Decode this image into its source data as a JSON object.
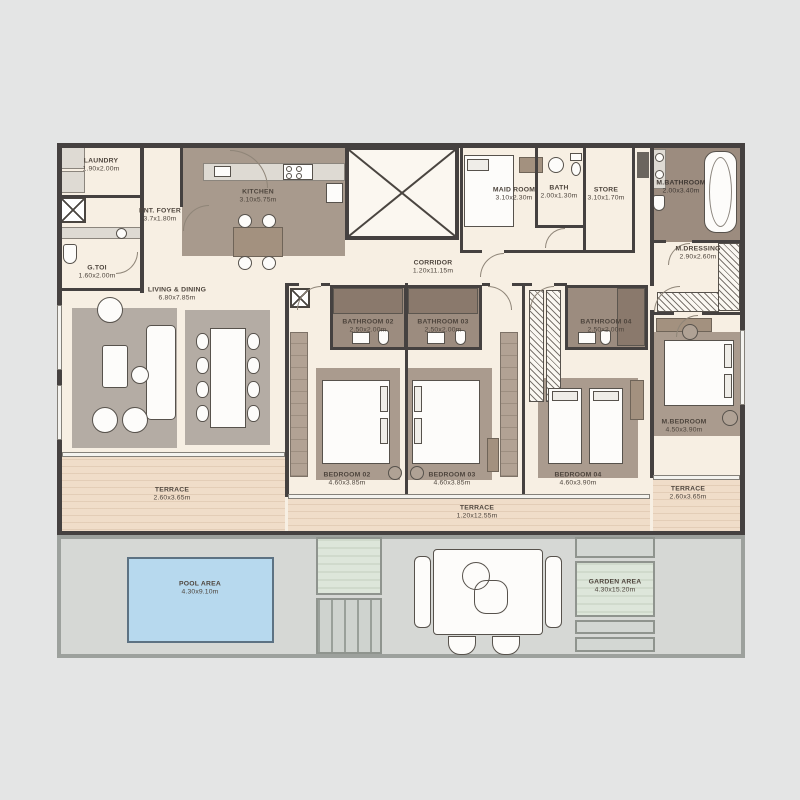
{
  "rooms": {
    "laundry": {
      "name": "LAUNDRY",
      "dims": "1.90x2.00m"
    },
    "g_toi": {
      "name": "G.TOI",
      "dims": "1.60x2.00m"
    },
    "ent_foyer": {
      "name": "ENT. FOYER",
      "dims": "3.7x1.80m"
    },
    "kitchen": {
      "name": "KITCHEN",
      "dims": "3.10x5.75m"
    },
    "maid_room": {
      "name": "MAID ROOM",
      "dims": "3.10x2.30m"
    },
    "bath": {
      "name": "BATH",
      "dims": "2.00x1.30m"
    },
    "store": {
      "name": "STORE",
      "dims": "3.10x1.70m"
    },
    "m_bathroom": {
      "name": "M.BATHROOM",
      "dims": "2.00x3.40m"
    },
    "m_dressing": {
      "name": "M.DRESSING",
      "dims": "2.90x2.60m"
    },
    "corridor": {
      "name": "CORRIDOR",
      "dims": "1.20x11.15m"
    },
    "living_dining": {
      "name": "LIVING & DINING",
      "dims": "6.80x7.85m"
    },
    "bathroom_02": {
      "name": "BATHROOM 02",
      "dims": "2.50x2.00m"
    },
    "bathroom_03": {
      "name": "BATHROOM 03",
      "dims": "2.50x2.00m"
    },
    "bathroom_04": {
      "name": "BATHROOM 04",
      "dims": "2.50x2.00m"
    },
    "bedroom_02": {
      "name": "BEDROOM 02",
      "dims": "4.60x3.85m"
    },
    "bedroom_03": {
      "name": "BEDROOM 03",
      "dims": "4.60x3.85m"
    },
    "bedroom_04": {
      "name": "BEDROOM 04",
      "dims": "4.60x3.90m"
    },
    "m_bedroom": {
      "name": "M.BEDROOM",
      "dims": "4.50x3.90m"
    },
    "terrace_left": {
      "name": "TERRACE",
      "dims": "2.60x3.65m"
    },
    "terrace_middle": {
      "name": "TERRACE",
      "dims": "1.20x12.55m"
    },
    "terrace_right": {
      "name": "TERRACE",
      "dims": "2.60x3.65m"
    },
    "pool_area": {
      "name": "POOL AREA",
      "dims": "4.30x9.10m"
    },
    "garden_area": {
      "name": "GARDEN AREA",
      "dims": "4.30x15.20m"
    }
  },
  "icons": [
    "washer",
    "stove",
    "sink",
    "toilet",
    "bathtub",
    "shower",
    "bed",
    "sofa",
    "dining-table",
    "wardrobe-rack",
    "stair-void-x",
    "pool",
    "planter",
    "steps",
    "outdoor-table"
  ],
  "colors": {
    "background": "#e4e5e5",
    "floor": "#f7efe3",
    "wall": "#454140",
    "kitchen_floor": "#a89a8d",
    "bath_floor": "#9c8c7f",
    "shower_floor": "#8a796c",
    "rug_gray": "#b4aca4",
    "rug_brown": "#aa9b8e",
    "terrace_wood": "#f0ddc9",
    "pool": "#b7d9ee",
    "outdoor_concrete": "#d6d8d5",
    "garden": "#dde6da",
    "wood_furniture": "#a3917f",
    "label_text": "#4e453d"
  }
}
